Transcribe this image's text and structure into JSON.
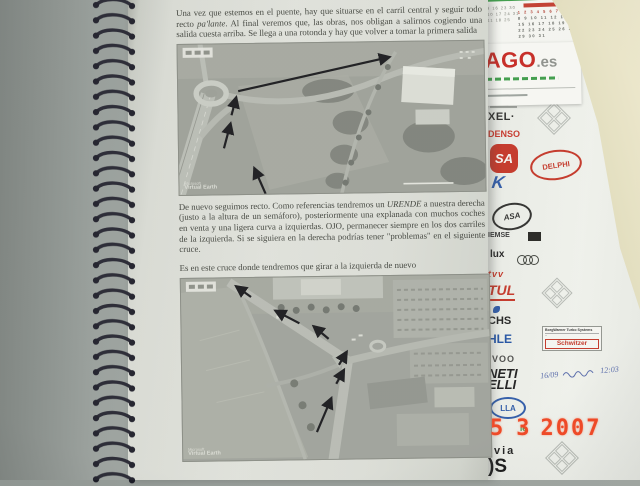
{
  "page": {
    "para1_pre": "Una vez que estemos en el puente, hay que situarse en el carril central y seguir todo recto ",
    "para1_italic": "pa'lante",
    "para1_post": ". Al final veremos que, las obras, nos obligan a salirnos cogiendo una salida cuesta arriba. Se llega a una rotonda y hay que volver a tomar la primera salida",
    "para2_pre": "De nuevo seguimos recto. Como referencias tendremos un ",
    "para2_italic": "URENDE",
    "para2_post": " a nuestra derecha (justo a la altura de un semáforo), posteriormente una explanada con muchos coches en venta y una ligera curva a izquierdas. OJO, permanecer siempre en los dos carriles de la izquierda. Si se siguiera en la derecha podrías tener \"problemas\" en el siguiente cruce.",
    "para3": "Es en este cruce donde tendremos que girar a la izquierda de nuevo"
  },
  "maps": {
    "watermark_line1": "Microsoft",
    "watermark_line2": "Virtual Earth"
  },
  "calendar": {
    "rows": [
      "1 2 3 4 5 6 7",
      "8 9 10 11 12 13 14",
      "15 16 17 18 19 20 21",
      "22 23 24 25 26 27 28",
      "29 30 31"
    ],
    "rows_left": [
      "2 9 16 23 30",
      "3 10 17 24 31",
      "4 11 18 25"
    ]
  },
  "brand_card": {
    "brand": "AGO",
    "suffix": ".es"
  },
  "logo_sheet": {
    "xel": "XEL·",
    "denso": "DENSO",
    "sa": "SA",
    "delphi": "DELPHI",
    "k": "K",
    "asa": "ASA",
    "iemse": "IEMSE",
    "lux": "lux",
    "tvv": "tvv",
    "tul": "TUL",
    "chs": "CHS",
    "hle": "HLE",
    "borg_line1": "BorgWarner Turbo Systems",
    "borg_line2": "Schwitzer",
    "voo": "VOO",
    "neti": "NETI",
    "elli": "ELLI",
    "lla": "LLA",
    "le": "le",
    "via": "via",
    "s": ")S",
    "note_date": "16/09",
    "note_time": "12:03"
  },
  "date_stamp": {
    "day": "5",
    "month": "3",
    "year": "2007"
  },
  "colors": {
    "date_stamp": "#ee4a28",
    "logo_red": "#c23324",
    "logo_blue": "#2b57a5",
    "calendar_green": "#3a9a46"
  }
}
